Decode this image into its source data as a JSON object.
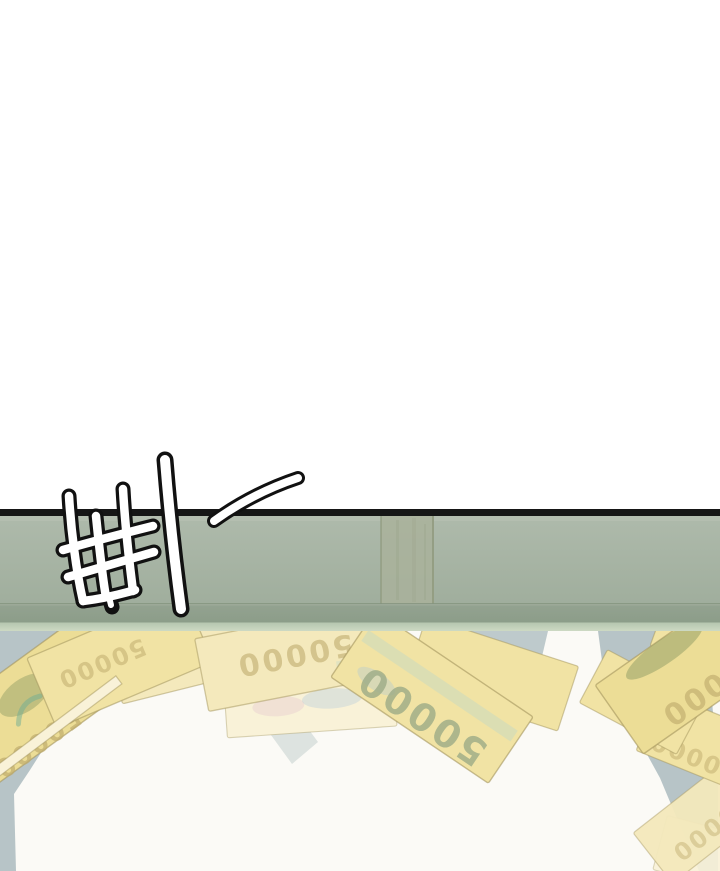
{
  "panel": {
    "sfx_text": "삐—",
    "denomination": "50000"
  },
  "colors": {
    "background": "#ffffff",
    "floor": "#fbfaf6",
    "desk_line": "#161616",
    "bar_top": "#aebaab",
    "bar_bottom": "#a0ae9d",
    "bar_highlight": "#b6c1b2",
    "seam": "#a9b19b",
    "seam_edge": "#8b9579",
    "divider": "#83937e",
    "strip_dark_top": "#93a290",
    "strip_dark_bottom": "#8c9d89",
    "strip_light_top": "#b5c6af",
    "strip_light_bottom": "#cdd9c3",
    "shadow": "#b3c1c4",
    "shadow_light": "#dde3e0",
    "bill_base": "#f1e3a4",
    "bill_deep": "#ecdd96",
    "bill_pale": "#f4e9bc",
    "bill_faint": "#f9f2d8",
    "bill_border": "#a3955e",
    "digit_tan": "#c0ad6e",
    "digit_green": "#9dac87",
    "blob_olive": "#8e9c63",
    "swirl_teal": "#6fae93",
    "holo_blue": "#a9c6da",
    "holo_teal": "#b7d8cc",
    "holo_pink": "#e3c3cf",
    "sfx_outline": "#111111",
    "sfx_fill": "#ffffff"
  }
}
